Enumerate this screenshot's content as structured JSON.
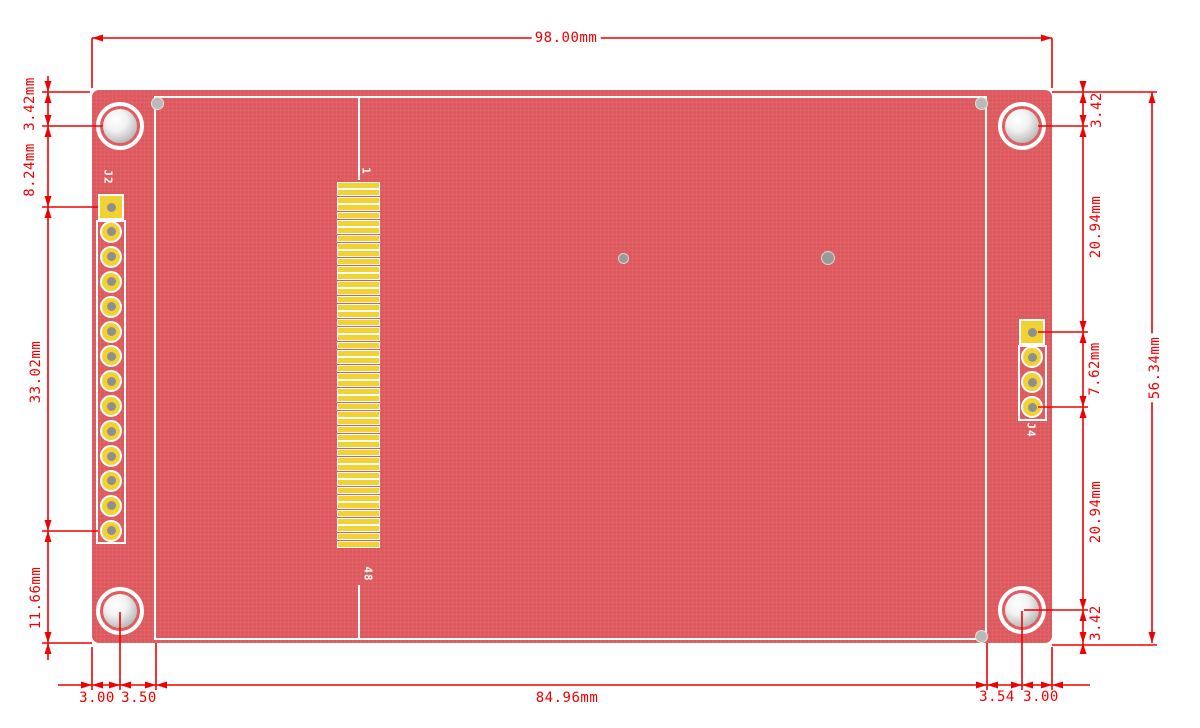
{
  "drawing": {
    "type": "pcb-dimension-drawing",
    "view": "back-of-lcd-module-board"
  },
  "dimensions": {
    "board_width": "98.00mm",
    "display_width": "84.96mm",
    "board_height": "56.34mm",
    "left": {
      "top_to_hole": "3.42mm",
      "hole_to_j2": "8.24mm",
      "j2_span": "33.02mm",
      "j2_to_bottom": "11.66mm"
    },
    "right": {
      "top_to_hole": "3.42",
      "hole_to_j4": "20.94mm",
      "j4_span": "7.62mm",
      "j4_to_hole": "20.94mm",
      "hole_to_bottom": "3.42"
    },
    "bottom_left": {
      "edge_to_hole": "3.00",
      "hole_to_display": "3.50"
    },
    "bottom_right": {
      "display_to_hole": "3.54",
      "hole_to_edge": "3.00"
    }
  },
  "silkscreen": {
    "j2_label": "J2",
    "j4_label": "J4",
    "pin1_label": "1",
    "pin48_label": "48"
  },
  "connectors": {
    "j2_pin_count": 14,
    "j4_pin_count": 4,
    "fpc_pin_count": 48
  },
  "colors": {
    "board_red": "#de595d",
    "dimension_red": "#f20000",
    "pad_yellow": "#f2d232",
    "drill_gray": "#8f8f8f",
    "silkscreen_white": "#ffffff"
  }
}
